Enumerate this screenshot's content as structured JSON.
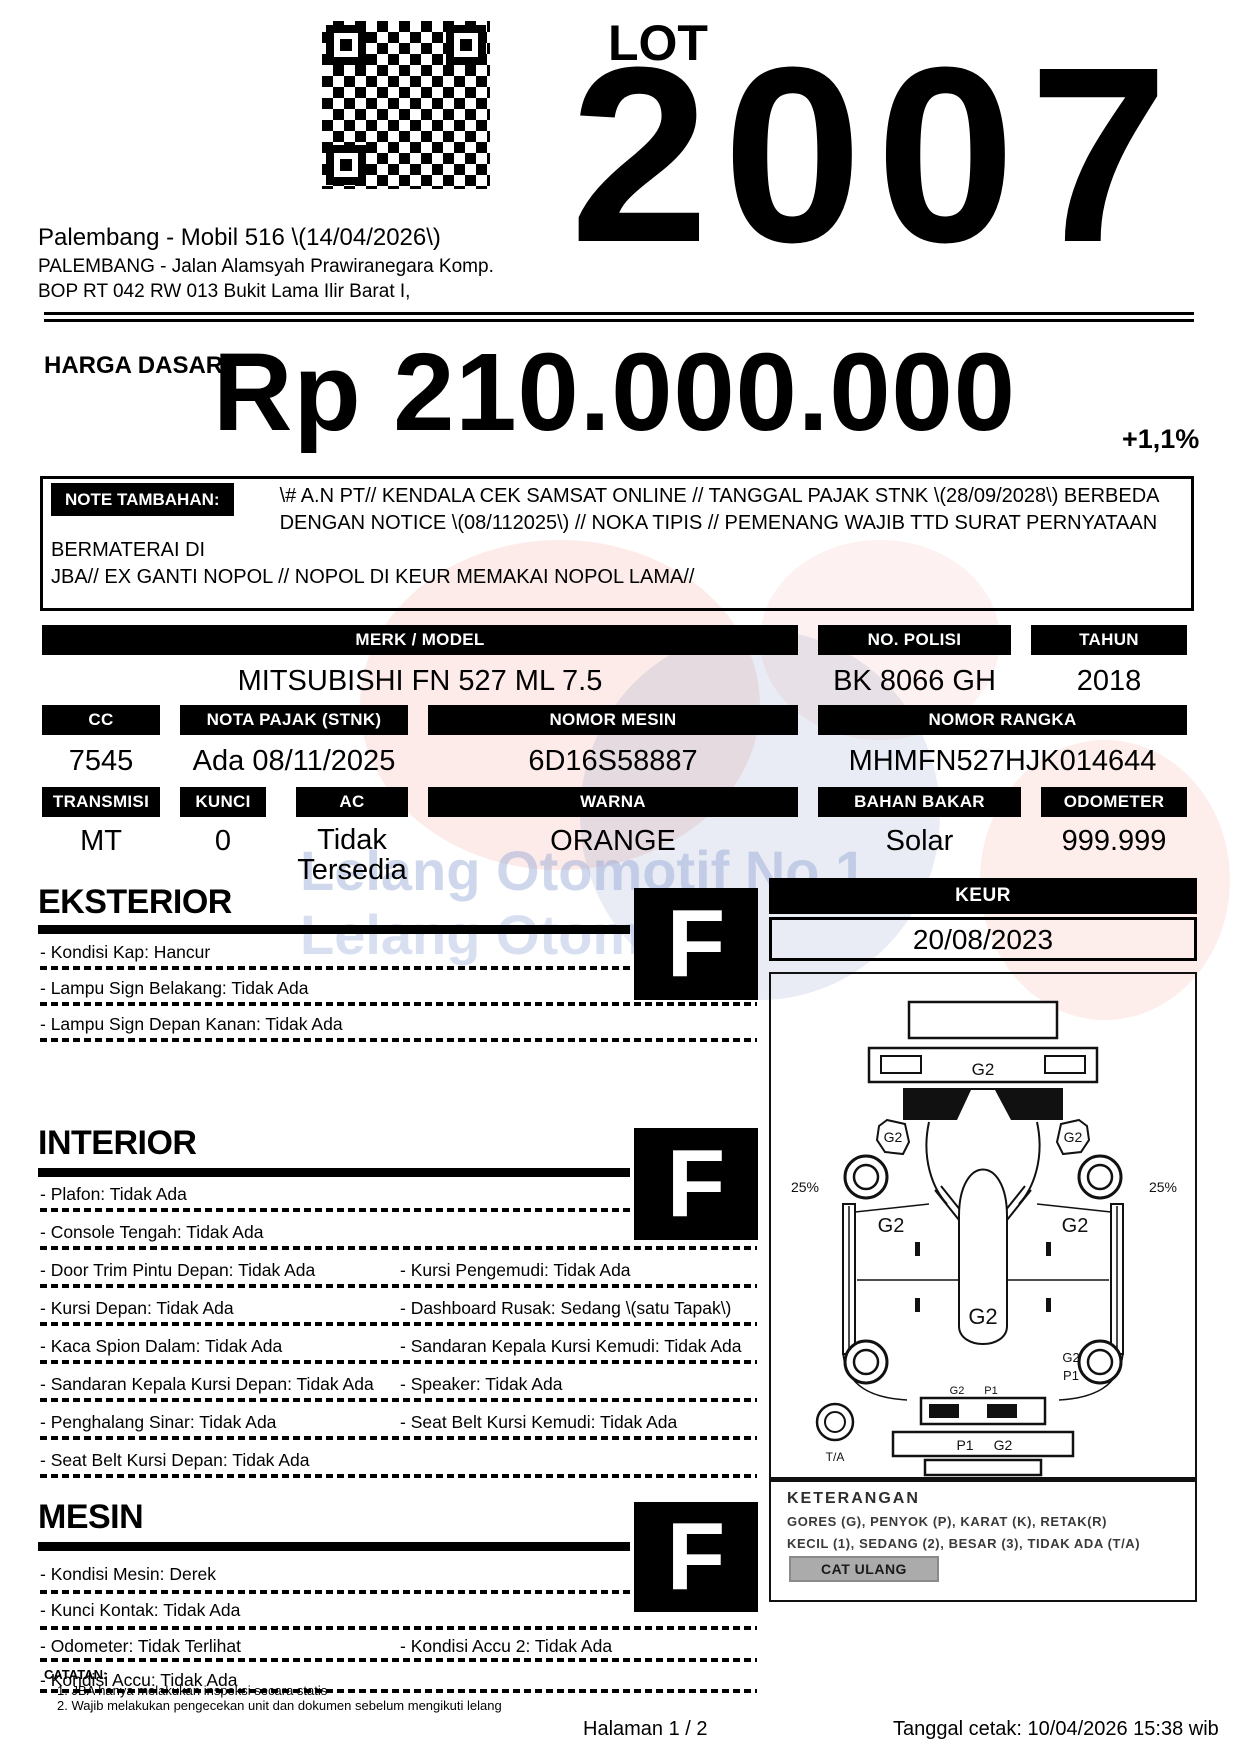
{
  "header": {
    "lot_label": "LOT",
    "lot_number": "2007",
    "auction_title": "Palembang - Mobil 516 \\(14/04/2026\\)",
    "address_line1": "PALEMBANG - Jalan Alamsyah Prawiranegara Komp.",
    "address_line2": "BOP RT 042 RW 013 Bukit Lama Ilir Barat I,"
  },
  "price": {
    "label": "HARGA DASAR :",
    "amount": "Rp 210.000.000",
    "change_percent": "+1,1%"
  },
  "note": {
    "label": "NOTE TAMBAHAN:",
    "lines": [
      "\\# A.N PT// KENDALA CEK SAMSAT ONLINE // TANGGAL PAJAK STNK \\(28/09/2028\\) BERBEDA",
      "DENGAN NOTICE \\(08/112025\\) // NOKA TIPIS // PEMENANG WAJIB TTD SURAT PERNYATAAN BERMATERAI DI",
      "JBA// EX GANTI NOPOL // NOPOL DI KEUR MEMAKAI NOPOL LAMA//"
    ]
  },
  "spec_table": {
    "row1": [
      {
        "label": "MERK / MODEL",
        "value": "MITSUBISHI FN 527 ML 7.5"
      },
      {
        "label": "NO. POLISI",
        "value": "BK 8066 GH"
      },
      {
        "label": "TAHUN",
        "value": "2018"
      }
    ],
    "row2": [
      {
        "label": "CC",
        "value": "7545"
      },
      {
        "label": "NOTA PAJAK (STNK)",
        "value": "Ada 08/11/2025"
      },
      {
        "label": "NOMOR MESIN",
        "value": "6D16S58887"
      },
      {
        "label": "NOMOR RANGKA",
        "value": "MHMFN527HJK014644"
      }
    ],
    "row3": [
      {
        "label": "TRANSMISI",
        "value": "MT"
      },
      {
        "label": "KUNCI",
        "value": "0"
      },
      {
        "label": "AC",
        "value": "Tidak Tersedia"
      },
      {
        "label": "WARNA",
        "value": "ORANGE"
      },
      {
        "label": "BAHAN BAKAR",
        "value": "Solar"
      },
      {
        "label": "ODOMETER",
        "value": "999.999"
      }
    ]
  },
  "sections": {
    "eksterior": {
      "title": "EKSTERIOR",
      "grade": "F",
      "rows": [
        {
          "left": "- Kondisi Kap: Hancur",
          "right": ""
        },
        {
          "left": "- Lampu Sign Belakang: Tidak Ada",
          "right": ""
        },
        {
          "left": "- Lampu Sign Depan Kanan: Tidak Ada",
          "right": ""
        }
      ]
    },
    "interior": {
      "title": "INTERIOR",
      "grade": "F",
      "rows": [
        {
          "left": "- Plafon: Tidak Ada",
          "right": ""
        },
        {
          "left": "- Console Tengah: Tidak Ada",
          "right": ""
        },
        {
          "left": "- Door Trim Pintu Depan: Tidak Ada",
          "right": "- Kursi Pengemudi: Tidak Ada"
        },
        {
          "left": "- Kursi Depan: Tidak Ada",
          "right": "- Dashboard Rusak: Sedang \\(satu Tapak\\)"
        },
        {
          "left": "- Kaca Spion Dalam: Tidak Ada",
          "right": "- Sandaran Kepala Kursi Kemudi: Tidak Ada"
        },
        {
          "left": "- Sandaran Kepala Kursi Depan: Tidak Ada",
          "right": "- Speaker: Tidak Ada"
        },
        {
          "left": "- Penghalang Sinar: Tidak Ada",
          "right": "- Seat Belt Kursi Kemudi: Tidak Ada"
        },
        {
          "left": "- Seat Belt Kursi Depan: Tidak Ada",
          "right": ""
        }
      ]
    },
    "mesin": {
      "title": "MESIN",
      "grade": "F",
      "rows": [
        {
          "left": "- Kondisi Mesin: Derek",
          "right": ""
        },
        {
          "left": "- Kunci Kontak: Tidak Ada",
          "right": ""
        },
        {
          "left": "- Odometer: Tidak Terlihat",
          "right": "- Kondisi Accu 2: Tidak Ada"
        },
        {
          "left": "- Kondisi Accu: Tidak Ada",
          "right": ""
        }
      ]
    }
  },
  "keur": {
    "label": "KEUR",
    "date": "20/08/2023"
  },
  "diagram": {
    "front_bumper": "G2",
    "mirror_left": "G2",
    "mirror_right": "G2",
    "tread_left": "25%",
    "tread_right": "25%",
    "fender_left": "G2",
    "fender_right": "G2",
    "body_center": "G2",
    "rear_right_top": "G2",
    "rear_right_bottom": "P1",
    "rear_inner_left": "G2",
    "rear_inner_right": "P1",
    "rear_bar_left": "P1",
    "rear_bar_right": "G2",
    "spare_tire": "T/A"
  },
  "keterangan": {
    "title": "KETERANGAN",
    "line1": "GORES (G), PENYOK (P), KARAT (K), RETAK(R)",
    "line2": "KECIL (1), SEDANG (2), BESAR (3), TIDAK ADA (T/A)",
    "button": "CAT ULANG"
  },
  "catatan": {
    "label": "CATATAN:",
    "line1": "1. JBA hanya melakukan inspeksi secara statis",
    "line2": "2. Wajib melakukan pengecekan unit dan dokumen sebelum mengikuti lelang"
  },
  "footer": {
    "page_number": "Halaman 1 / 2",
    "printed": "Tanggal cetak: 10/04/2026 15:38 wib"
  },
  "watermark": {
    "line1": "Lelang Otomotif No.1",
    "line2": "Lelang Otomotif"
  },
  "colors": {
    "logo_red": "#e85948",
    "logo_blue": "#4a5fb0",
    "watermark_text": "#8ca0d2",
    "button_gray": "#ababab"
  }
}
